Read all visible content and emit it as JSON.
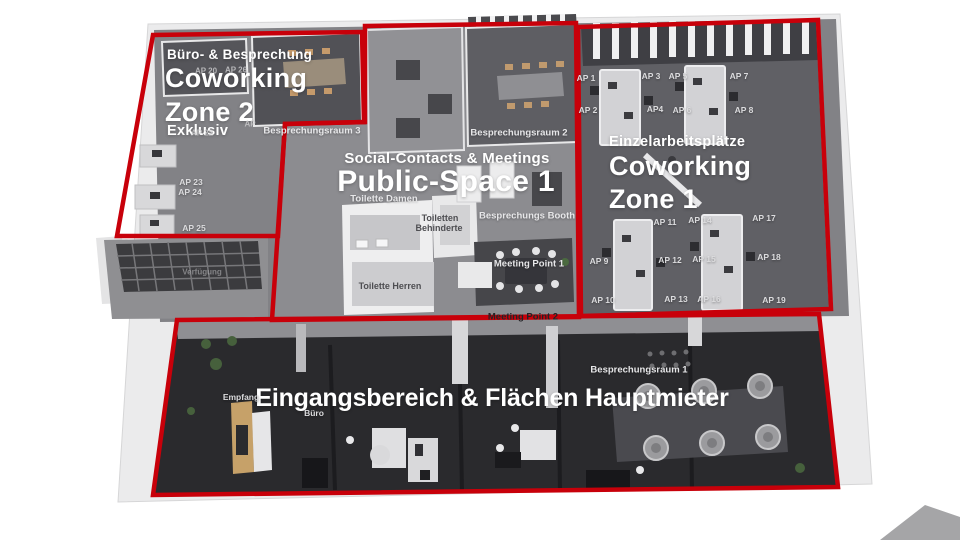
{
  "palette": {
    "zone_outline": "#c8000a",
    "ground_floor": "#2a2a2d",
    "mid_floor": "#88888b",
    "room_dark": "#55555a",
    "wall_white": "#efeff1",
    "slab": "#ebebec",
    "title_text": "#ffffff"
  },
  "zones": {
    "coworking_zone_2": {
      "category": "Büro- & Besprechung",
      "title_line1": "Coworking",
      "title_line2": "Zone 2",
      "subtitle": "Exklusiv"
    },
    "public_space_1": {
      "category": "Social-Contacts & Meetings",
      "title": "Public-Space 1"
    },
    "coworking_zone_1": {
      "category": "Einzelarbeitsplätze",
      "title_line1": "Coworking",
      "title_line2": "Zone 1"
    },
    "main_tenant": {
      "title": "Eingangsbereich & Flächen Hauptmieter"
    }
  },
  "labels": [
    {
      "id": "ap-20",
      "text": "AP 20"
    },
    {
      "id": "ap-26",
      "text": "AP 26"
    },
    {
      "id": "ap-21-partial",
      "text": "AP"
    },
    {
      "id": "ap-22",
      "text": "AP 22"
    },
    {
      "id": "ap-23",
      "text": "AP 23"
    },
    {
      "id": "ap-24",
      "text": "AP 24"
    },
    {
      "id": "ap-25",
      "text": "AP 25"
    },
    {
      "id": "besprechungsraum-3",
      "text": "Besprechungsraum 3"
    },
    {
      "id": "besprechungsraum-2",
      "text": "Besprechungsraum 2"
    },
    {
      "id": "toilette-damen",
      "text": "Toilette Damen"
    },
    {
      "id": "toiletten-behinderte-1",
      "text": "Toiletten"
    },
    {
      "id": "toiletten-behinderte-2",
      "text": "Behinderte"
    },
    {
      "id": "toilette-herren",
      "text": "Toilette Herren"
    },
    {
      "id": "besprechungs-booth",
      "text": "Besprechungs Booth"
    },
    {
      "id": "meeting-point-1",
      "text": "Meeting Point 1"
    },
    {
      "id": "meeting-point-2",
      "text": "Meeting Point 2"
    },
    {
      "id": "verfuegung",
      "text": "Verfügung"
    },
    {
      "id": "ap-1",
      "text": "AP 1"
    },
    {
      "id": "ap-2",
      "text": "AP 2"
    },
    {
      "id": "ap-3",
      "text": "AP 3"
    },
    {
      "id": "ap-4",
      "text": "AP4"
    },
    {
      "id": "ap-5",
      "text": "AP 5"
    },
    {
      "id": "ap-6",
      "text": "AP 6"
    },
    {
      "id": "ap-7",
      "text": "AP 7"
    },
    {
      "id": "ap-8",
      "text": "AP 8"
    },
    {
      "id": "ap-9",
      "text": "AP 9"
    },
    {
      "id": "ap-10",
      "text": "AP 10"
    },
    {
      "id": "ap-11",
      "text": "AP 11"
    },
    {
      "id": "ap-12",
      "text": "AP 12"
    },
    {
      "id": "ap-13",
      "text": "AP 13"
    },
    {
      "id": "ap-14",
      "text": "AP 14"
    },
    {
      "id": "ap-15",
      "text": "AP 15"
    },
    {
      "id": "ap-16",
      "text": "AP 16"
    },
    {
      "id": "ap-17",
      "text": "AP 17"
    },
    {
      "id": "ap-18",
      "text": "AP 18"
    },
    {
      "id": "ap-19",
      "text": "AP 19"
    },
    {
      "id": "empfang",
      "text": "Empfang"
    },
    {
      "id": "buero",
      "text": "Büro"
    },
    {
      "id": "besprechungsraum-1",
      "text": "Besprechungsraum 1"
    }
  ]
}
